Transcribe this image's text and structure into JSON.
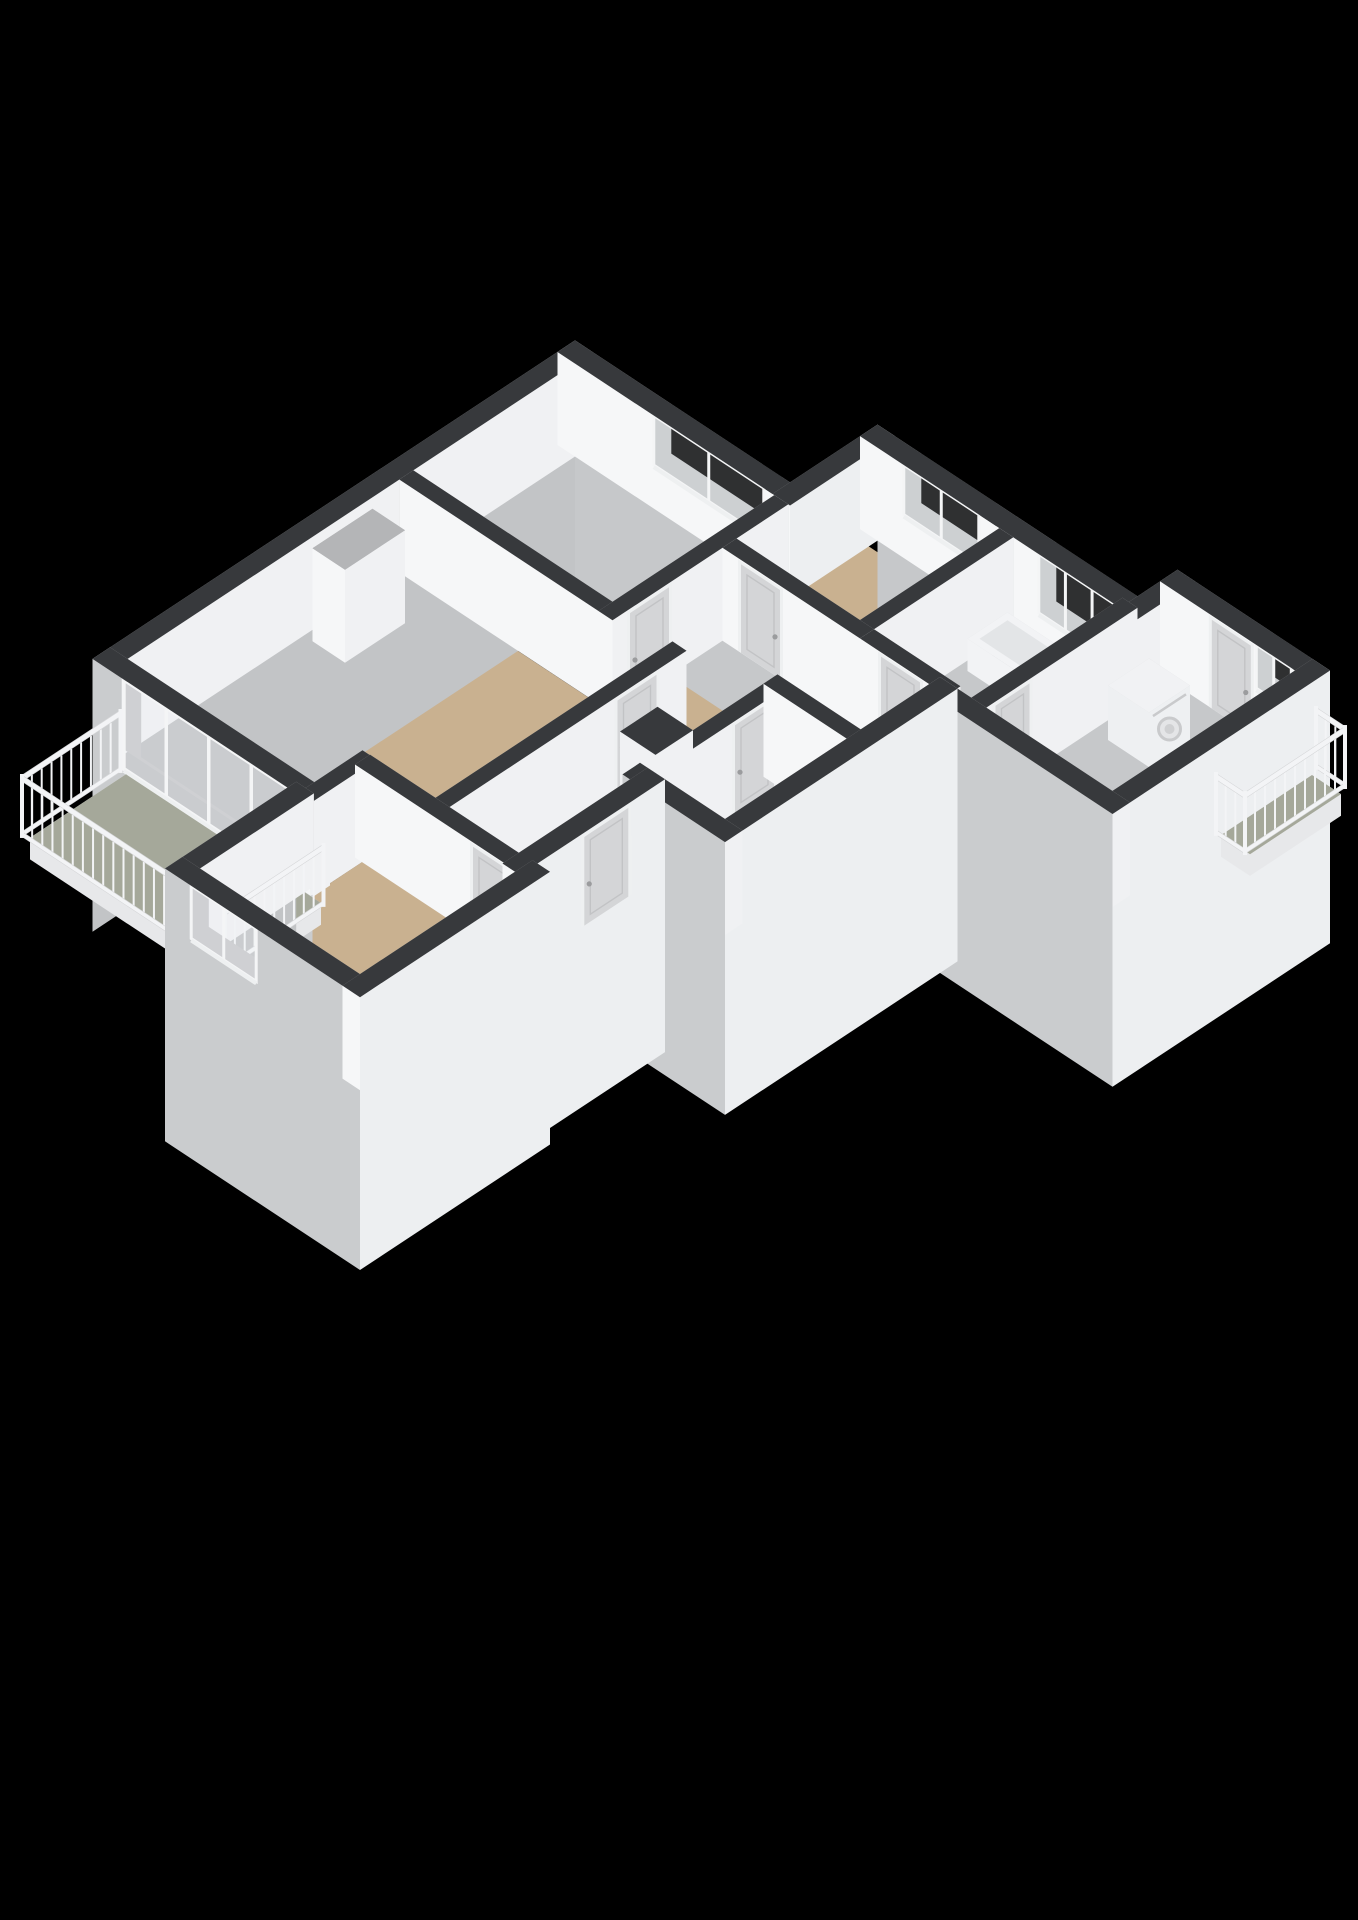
{
  "meta": {
    "description": "3D isometric cutaway floor plan render of an apartment on a black background",
    "render_style": "dollhouse-3d"
  },
  "colors": {
    "background": "#000000",
    "wallTop": "#37393c",
    "intPU": "#f0f1f3",
    "intPV": "#f6f7f8",
    "intNU": "#b6b7b9",
    "intNV": "#c8c9cb",
    "extPU": "#edeff1",
    "extPV": "#caccce",
    "extNU": "#c2c4c6",
    "extNV": "#c6c8ca",
    "floorWood": "#c9b190",
    "floorBalcony": "#a5a89a",
    "floorBath": "#c9d1d9",
    "slabSide": "#e7e8ea",
    "frame": "#f4f5f6",
    "glassTint": "rgba(235,240,245,0.20)",
    "doorPanel": "#d4d5d7",
    "doorFrame": "#eef0f1",
    "doorInner": "#c2c3c5",
    "handle": "#9b9c9e",
    "railing": "#f3f4f6",
    "railingStroke": "#d6d7d9",
    "applianceBody": "#eef0f2",
    "applianceTop": "#f1f2f4",
    "applianceDetail": "#c9cacc",
    "tubBody": "#f2f3f5",
    "tubInner": "#e3e5e7",
    "nicheDark": "#0c0c0c",
    "columnTop": "#b4b5b7"
  },
  "projection": {
    "ox": 575,
    "oy": 445,
    "hx": 50,
    "hy": 33,
    "zs": 62,
    "wallHeight": 1.5,
    "exteriorDrop": 2.9
  },
  "floors": [
    {
      "name": "floor-bedroom-top",
      "color": "floorWood",
      "poly": [
        [
          0.35,
          0.35
        ],
        [
          4.16,
          0.35
        ],
        [
          4.16,
          3.41
        ],
        [
          0.35,
          3.41
        ]
      ]
    },
    {
      "name": "floor-living-room",
      "color": "floorWood",
      "poly": [
        [
          0.35,
          3.69
        ],
        [
          5.36,
          3.69
        ],
        [
          5.36,
          8.16
        ],
        [
          4.19,
          8.16
        ],
        [
          4.19,
          9.12
        ],
        [
          0.35,
          9.12
        ]
      ]
    },
    {
      "name": "floor-kitchen",
      "color": "floorWood",
      "poly": [
        [
          4.44,
          -1.4
        ],
        [
          6.91,
          -1.4
        ],
        [
          6.91,
          1.21
        ],
        [
          4.44,
          1.21
        ]
      ]
    },
    {
      "name": "floor-hallway",
      "color": "floorWood",
      "poly": [
        [
          4.44,
          1.49
        ],
        [
          6.91,
          1.49
        ],
        [
          6.91,
          8.16
        ],
        [
          5.64,
          8.16
        ],
        [
          5.64,
          3.69
        ],
        [
          4.44,
          3.69
        ]
      ]
    },
    {
      "name": "floor-toilet",
      "color": "floorWood",
      "poly": [
        [
          7.19,
          1.49
        ],
        [
          8.57,
          1.49
        ],
        [
          8.57,
          2.86
        ],
        [
          7.19,
          2.86
        ]
      ]
    },
    {
      "name": "floor-storage",
      "color": "floorWood",
      "poly": [
        [
          7.19,
          3.14
        ],
        [
          8.57,
          3.14
        ],
        [
          8.57,
          5.57
        ],
        [
          7.19,
          5.57
        ]
      ]
    },
    {
      "name": "floor-bathroom",
      "color": "floorBath",
      "poly": [
        [
          7.19,
          -1.4
        ],
        [
          9.21,
          -1.4
        ],
        [
          9.21,
          1.21
        ],
        [
          7.19,
          1.21
        ]
      ]
    },
    {
      "name": "floor-utility-room",
      "color": "floorWood",
      "poly": [
        [
          9.52,
          -2.37
        ],
        [
          12.02,
          -2.37
        ],
        [
          12.02,
          1.27
        ],
        [
          9.52,
          1.27
        ]
      ]
    },
    {
      "name": "floor-bedroom-bottom",
      "color": "floorWood",
      "poly": [
        [
          4.19,
          8.44
        ],
        [
          7.27,
          8.44
        ],
        [
          7.27,
          11.57
        ],
        [
          4.19,
          11.57
        ]
      ]
    }
  ],
  "slabs": [
    {
      "name": "balcony-left-floor",
      "color": "floorBalcony",
      "poly": [
        [
          0.5,
          9.48
        ],
        [
          4.4,
          9.48
        ],
        [
          4.4,
          11.4
        ],
        [
          0.5,
          11.4
        ]
      ],
      "drop": 0.35
    },
    {
      "name": "balcony-right-floor",
      "color": "floorBalcony",
      "poly": [
        [
          12.37,
          -2.37
        ],
        [
          12.95,
          -2.37
        ],
        [
          12.95,
          -0.55
        ],
        [
          12.37,
          -0.55
        ]
      ],
      "drop": 0.35
    }
  ],
  "walls": [
    {
      "name": "wall-exterior-nw",
      "from": [
        0,
        -0.175
      ],
      "to": [
        0,
        9.475
      ],
      "t": 0.35,
      "ext": true,
      "out": "-u"
    },
    {
      "name": "wall-bedroom-top-ne",
      "from": [
        -0.175,
        0
      ],
      "to": [
        4.475,
        0
      ],
      "t": 0.35,
      "ext": true,
      "out": "-v",
      "openings": [
        {
          "kind": "window",
          "a0": 1.75,
          "a1": 3.95,
          "z0": 0.7,
          "z1": 1.5,
          "panes": 2
        }
      ]
    },
    {
      "name": "wall-step-ne",
      "from": [
        4.3,
        0.175
      ],
      "to": [
        4.3,
        -1.925
      ],
      "t": 0.35,
      "ext": true,
      "out": "+u",
      "drop": 0
    },
    {
      "name": "wall-kitchen-bath-ne",
      "from": [
        4.125,
        -1.75
      ],
      "to": [
        9.675,
        -1.75
      ],
      "t": 0.35,
      "ext": true,
      "out": "-v",
      "openings": [
        {
          "kind": "window",
          "a0": 5.0,
          "a1": 6.5,
          "z0": 0.7,
          "z1": 1.5,
          "panes": 2
        },
        {
          "kind": "window",
          "a0": 7.7,
          "a1": 9.3,
          "z0": 0.55,
          "z1": 1.5,
          "panes": 3
        }
      ]
    },
    {
      "name": "wall-utility-jog",
      "from": [
        9.5,
        -1.575
      ],
      "to": [
        9.5,
        -2.725
      ],
      "t": 0.35,
      "ext": true,
      "out": "-u",
      "drop": 0
    },
    {
      "name": "wall-utility-ne",
      "from": [
        9.325,
        -2.55
      ],
      "to": [
        12.375,
        -2.55
      ],
      "t": 0.35,
      "ext": true,
      "out": "-v",
      "openings": [
        {
          "kind": "door",
          "a0": 10.3,
          "a1": 11.2,
          "z0": 0,
          "z1": 1.5
        },
        {
          "kind": "window",
          "a0": 11.25,
          "a1": 11.95,
          "z0": 0.8,
          "z1": 1.5,
          "panes": 2
        }
      ]
    },
    {
      "name": "wall-utility-se",
      "from": [
        12.2,
        -2.725
      ],
      "to": [
        12.2,
        1.625
      ],
      "t": 0.35,
      "ext": true,
      "out": "+u"
    },
    {
      "name": "wall-utility-sw",
      "from": [
        8.575,
        1.45
      ],
      "to": [
        12.375,
        1.45
      ],
      "t": 0.35,
      "ext": true,
      "out": "+v"
    },
    {
      "name": "wall-block-se",
      "from": [
        8.75,
        1.275
      ],
      "to": [
        8.75,
        5.925
      ],
      "t": 0.35,
      "ext": true,
      "out": "+u"
    },
    {
      "name": "wall-entry-top-sw",
      "from": [
        6.875,
        5.75
      ],
      "to": [
        8.925,
        5.75
      ],
      "t": 0.35,
      "ext": true,
      "out": "+v"
    },
    {
      "name": "wall-entry-se",
      "from": [
        7.2,
        5.575
      ],
      "to": [
        7.2,
        8.475
      ],
      "t": 0.35,
      "ext": true,
      "out": "+u",
      "openings": [
        {
          "kind": "door",
          "a0": 6.25,
          "a1": 7.25,
          "z0": 0,
          "z1": 1.5
        }
      ]
    },
    {
      "name": "wall-bedroom-bottom-ne",
      "from": [
        4.05,
        8.3
      ],
      "to": [
        7.375,
        8.3
      ],
      "t": 0.3,
      "openings": [
        {
          "kind": "door",
          "a0": 6.35,
          "a1": 7.2,
          "z0": 0,
          "z1": 1.5
        }
      ]
    },
    {
      "name": "wall-bedroom-bottom-se",
      "from": [
        7.45,
        8.125
      ],
      "to": [
        7.45,
        11.925
      ],
      "t": 0.35,
      "ext": true,
      "out": "+u"
    },
    {
      "name": "wall-bedroom-bottom-sw",
      "from": [
        3.725,
        11.75
      ],
      "to": [
        7.625,
        11.75
      ],
      "t": 0.35,
      "ext": true,
      "out": "+v",
      "openings": [
        {
          "kind": "window",
          "a0": 4.25,
          "a1": 5.55,
          "z0": 0.65,
          "z1": 1.5,
          "panes": 2
        }
      ]
    },
    {
      "name": "wall-bedroom-bottom-nw",
      "from": [
        3.9,
        9.3
      ],
      "to": [
        3.9,
        11.925
      ],
      "t": 0.35,
      "ext": true,
      "out": "-u"
    },
    {
      "name": "wall-living-sw-glazed",
      "from": [
        -0.175,
        9.3
      ],
      "to": [
        4.225,
        9.3
      ],
      "t": 0.35,
      "ext": true,
      "out": "+v",
      "drop": 1.35,
      "openings": [
        {
          "kind": "slider",
          "a0": 0.45,
          "a1": 3.85,
          "z0": 0.06,
          "z1": 1.5,
          "panes": 4
        }
      ]
    },
    {
      "name": "wall-separator-top",
      "from": [
        0.175,
        3.55
      ],
      "to": [
        5.64,
        3.55
      ],
      "t": 0.28
    },
    {
      "name": "wall-bedroom-top-hall",
      "from": [
        4.3,
        0.175
      ],
      "to": [
        4.3,
        3.69
      ],
      "t": 0.28,
      "openings": [
        {
          "kind": "door",
          "a0": 2.5,
          "a1": 3.4,
          "z0": 0,
          "z1": 1.5
        }
      ]
    },
    {
      "name": "wall-hall-nw",
      "from": [
        5.5,
        3.41
      ],
      "to": [
        5.5,
        8.44
      ],
      "t": 0.28,
      "openings": [
        {
          "kind": "door",
          "a0": 3.95,
          "a1": 4.85,
          "z0": 0,
          "z1": 1.5
        }
      ]
    },
    {
      "name": "wall-kitchen-s",
      "from": [
        4.44,
        1.35
      ],
      "to": [
        7.19,
        1.35
      ],
      "t": 0.28,
      "openings": [
        {
          "kind": "door",
          "a0": 4.75,
          "a1": 5.65,
          "z0": 0,
          "z1": 1.5
        }
      ]
    },
    {
      "name": "wall-hall-se",
      "from": [
        7.05,
        -1.575
      ],
      "to": [
        7.05,
        5.89
      ],
      "t": 0.28,
      "openings": [
        {
          "kind": "door",
          "a0": 1.8,
          "a1": 2.7,
          "z0": 0,
          "z1": 1.5
        },
        {
          "kind": "door",
          "a0": 3.15,
          "a1": 4.05,
          "z0": 0,
          "z1": 1.5
        }
      ]
    },
    {
      "name": "wall-toilet-s",
      "from": [
        6.91,
        3.0
      ],
      "to": [
        8.92,
        3.0
      ],
      "t": 0.28
    },
    {
      "name": "wall-bath-s",
      "from": [
        7.19,
        1.35
      ],
      "to": [
        8.92,
        1.35
      ],
      "t": 0.28,
      "openings": [
        {
          "kind": "door",
          "a0": 7.55,
          "a1": 8.45,
          "z0": 0,
          "z1": 1.5
        }
      ]
    },
    {
      "name": "wall-utility-nw",
      "from": [
        9.35,
        -1.75
      ],
      "to": [
        9.35,
        1.59
      ],
      "t": 0.3,
      "openings": [
        {
          "kind": "door",
          "a0": 0.35,
          "a1": 1.15,
          "z0": 0,
          "z1": 1.5
        }
      ]
    },
    {
      "name": "wall-living-bb",
      "from": [
        4.05,
        8.16
      ],
      "to": [
        4.05,
        9.475
      ],
      "t": 0.28
    }
  ],
  "prisms": [
    {
      "name": "living-room-column",
      "u0": 0.35,
      "u1": 1.0,
      "v0": 4.4,
      "v1": 5.6,
      "h": 1.5,
      "top": "columnTop"
    },
    {
      "name": "hall-duct-shaft",
      "u0": 6.2,
      "u1": 6.91,
      "v0": 4.55,
      "v1": 5.3,
      "h": 1.5,
      "top": "wallTop",
      "detail": "niche"
    },
    {
      "name": "washing-machine",
      "u0": 9.8,
      "u1": 10.62,
      "v0": -1.68,
      "v1": -0.86,
      "h": 0.88,
      "top": "applianceTop",
      "detail": "washer"
    },
    {
      "name": "bathtub",
      "u0": 7.35,
      "u1": 9.05,
      "v0": -1.3,
      "v1": -0.5,
      "h": 0.52,
      "top": "tubBody",
      "detail": "tub"
    }
  ],
  "railings": [
    {
      "name": "balcony-left-railing-nw",
      "from": [
        0.46,
        9.55
      ],
      "to": [
        0.46,
        11.52
      ],
      "h": 1.05
    },
    {
      "name": "balcony-left-railing-sw",
      "from": [
        0.46,
        11.52
      ],
      "to": [
        4.52,
        11.52
      ],
      "h": 1.05
    },
    {
      "name": "balcony-left-railing-se",
      "from": [
        4.52,
        9.55
      ],
      "to": [
        4.52,
        11.52
      ],
      "h": 1.05
    },
    {
      "name": "balcony-right-railing-ne",
      "from": [
        12.37,
        -2.45
      ],
      "to": [
        12.95,
        -2.45
      ],
      "h": 1.05
    },
    {
      "name": "balcony-right-railing-se",
      "from": [
        12.95,
        -2.45
      ],
      "to": [
        12.95,
        -0.45
      ],
      "h": 1.05
    },
    {
      "name": "balcony-right-railing-sw",
      "from": [
        12.37,
        -0.45
      ],
      "to": [
        12.95,
        -0.45
      ],
      "h": 1.05
    }
  ]
}
